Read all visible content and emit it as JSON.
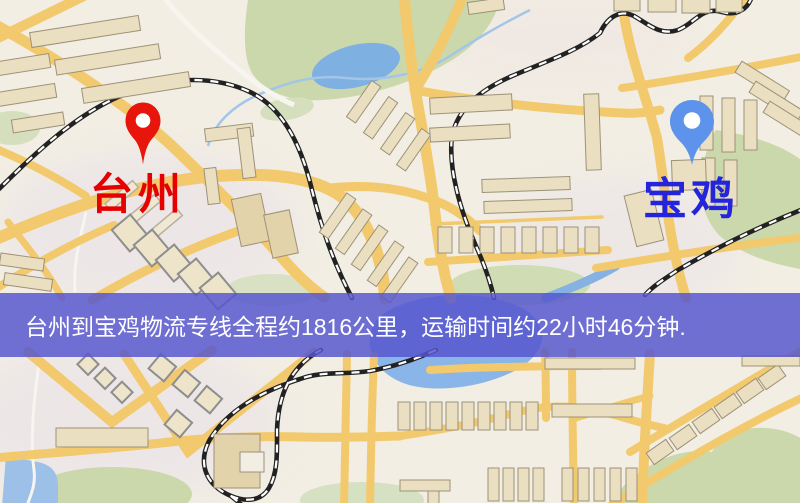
{
  "page": {
    "width": 800,
    "height": 503
  },
  "map": {
    "markers": [
      {
        "id": "origin",
        "label": "台州",
        "pin_color": "#e8150d",
        "label_color": "#e60000"
      },
      {
        "id": "destination",
        "label": "宝鸡",
        "pin_color": "#5d93ea",
        "label_color": "#2424dd"
      }
    ]
  },
  "banner": {
    "text": "台州到宝鸡物流专线全程约1816公里，运输时间约22小时46分钟.",
    "origin": "台州",
    "destination": "宝鸡",
    "distance": "约1816公里",
    "duration": "约22小时46分钟",
    "background_color": "#5656ce",
    "text_color": "#ffffff"
  }
}
